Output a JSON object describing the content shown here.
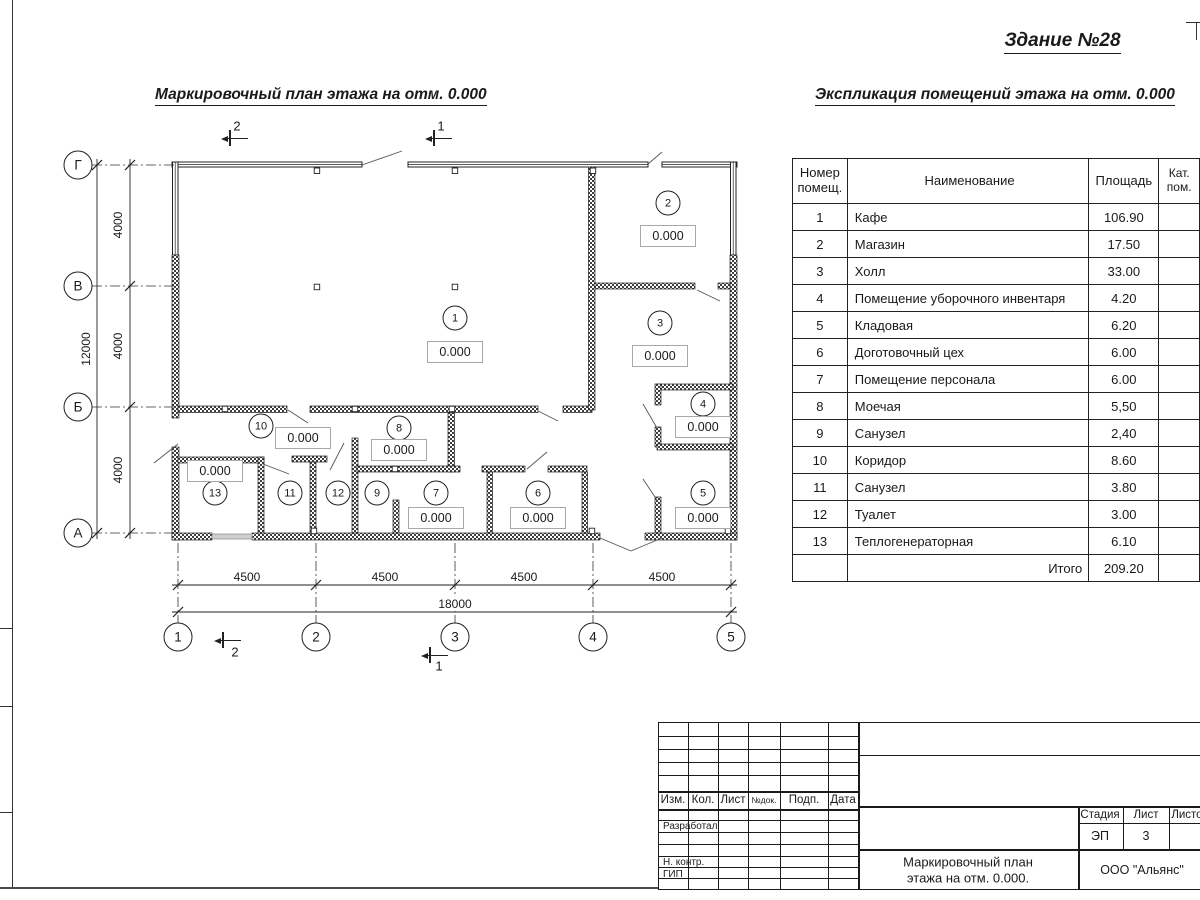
{
  "sheet": {
    "building_title": "Здание №28",
    "plan_title": "Маркировочный план этажа на отм. 0.000",
    "table_title": "Экспликация помещений этажа на отм. 0.000"
  },
  "explication": {
    "headers": {
      "num": "Номер помещ.",
      "name": "Наименование",
      "area": "Площадь",
      "cat": "Кат. пом."
    },
    "rows": [
      {
        "num": "1",
        "name": "Кафе",
        "area": "106.90"
      },
      {
        "num": "2",
        "name": "Магазин",
        "area": "17.50"
      },
      {
        "num": "3",
        "name": "Холл",
        "area": "33.00"
      },
      {
        "num": "4",
        "name": "Помещение уборочного инвентаря",
        "area": "4.20"
      },
      {
        "num": "5",
        "name": "Кладовая",
        "area": "6.20"
      },
      {
        "num": "6",
        "name": "Доготовочный цех",
        "area": "6.00"
      },
      {
        "num": "7",
        "name": "Помещение персонала",
        "area": "6.00"
      },
      {
        "num": "8",
        "name": "Моечая",
        "area": "5,50"
      },
      {
        "num": "9",
        "name": "Санузел",
        "area": "2,40"
      },
      {
        "num": "10",
        "name": "Коридор",
        "area": "8.60"
      },
      {
        "num": "11",
        "name": "Санузел",
        "area": "3.80"
      },
      {
        "num": "12",
        "name": "Туалет",
        "area": "3.00"
      },
      {
        "num": "13",
        "name": "Теплогенераторная",
        "area": "6.10"
      }
    ],
    "total_label": "Итого",
    "total_value": "209.20"
  },
  "plan": {
    "axes_vertical": [
      {
        "label": "Г",
        "y": 165
      },
      {
        "label": "В",
        "y": 286
      },
      {
        "label": "Б",
        "y": 407
      },
      {
        "label": "А",
        "y": 533
      }
    ],
    "axes_horizontal": [
      {
        "label": "1",
        "x": 178
      },
      {
        "label": "2",
        "x": 316
      },
      {
        "label": "3",
        "x": 455
      },
      {
        "label": "4",
        "x": 593
      },
      {
        "label": "5",
        "x": 731
      }
    ],
    "dim_left_segments": [
      {
        "label": "4000",
        "y": 225
      },
      {
        "label": "4000",
        "y": 346
      },
      {
        "label": "4000",
        "y": 470
      }
    ],
    "dim_left_total": {
      "label": "12000",
      "y": 349
    },
    "dim_bottom_segments": [
      {
        "label": "4500",
        "x": 247
      },
      {
        "label": "4500",
        "x": 385
      },
      {
        "label": "4500",
        "x": 524
      },
      {
        "label": "4500",
        "x": 662
      }
    ],
    "dim_bottom_total": {
      "label": "18000",
      "x": 455
    },
    "rooms": [
      {
        "id": "1",
        "cx": 455,
        "cy": 318,
        "elev": "0.000",
        "bx": 455,
        "by": 352
      },
      {
        "id": "2",
        "cx": 668,
        "cy": 203,
        "elev": "0.000",
        "bx": 668,
        "by": 236
      },
      {
        "id": "3",
        "cx": 660,
        "cy": 323,
        "elev": "0.000",
        "bx": 660,
        "by": 356
      },
      {
        "id": "4",
        "cx": 703,
        "cy": 404,
        "elev": "0.000",
        "bx": 703,
        "by": 427
      },
      {
        "id": "5",
        "cx": 703,
        "cy": 493,
        "elev": "0.000",
        "bx": 703,
        "by": 518
      },
      {
        "id": "6",
        "cx": 538,
        "cy": 493,
        "elev": "0.000",
        "bx": 538,
        "by": 518
      },
      {
        "id": "7",
        "cx": 436,
        "cy": 493,
        "elev": "0.000",
        "bx": 436,
        "by": 518
      },
      {
        "id": "8",
        "cx": 399,
        "cy": 428,
        "elev": "0.000",
        "bx": 399,
        "by": 450
      },
      {
        "id": "9",
        "cx": 377,
        "cy": 493
      },
      {
        "id": "10",
        "cx": 261,
        "cy": 426,
        "elev": "0.000",
        "bx": 303,
        "by": 438
      },
      {
        "id": "11",
        "cx": 290,
        "cy": 493
      },
      {
        "id": "12",
        "cx": 338,
        "cy": 493
      },
      {
        "id": "13",
        "cx": 215,
        "cy": 493,
        "elev": "0.000",
        "bx": 215,
        "by": 471
      }
    ],
    "section_marks": [
      {
        "label": "2",
        "x": 237,
        "y": 126,
        "ax": 221,
        "ay": 139
      },
      {
        "label": "1",
        "x": 441,
        "y": 126,
        "ax": 425,
        "ay": 139
      },
      {
        "label": "2",
        "x": 235,
        "y": 652,
        "ax": 214,
        "ay": 641
      },
      {
        "label": "1",
        "x": 439,
        "y": 666,
        "ax": 421,
        "ay": 656
      }
    ]
  },
  "titleblock": {
    "rev_headers": [
      "Изм.",
      "Кол.",
      "Лист",
      "№док.",
      "Подп.",
      "Дата"
    ],
    "roles": [
      "Разработал",
      "Н. контр.",
      "ГИП"
    ],
    "stage_label": "Стадия",
    "sheet_label": "Лист",
    "sheets_label": "Листов",
    "stage_value": "ЭП",
    "sheet_value": "3",
    "doc_title_line1": "Маркировочный план",
    "doc_title_line2": "этажа на отм. 0.000.",
    "company": "ООО \"Альянс\""
  }
}
